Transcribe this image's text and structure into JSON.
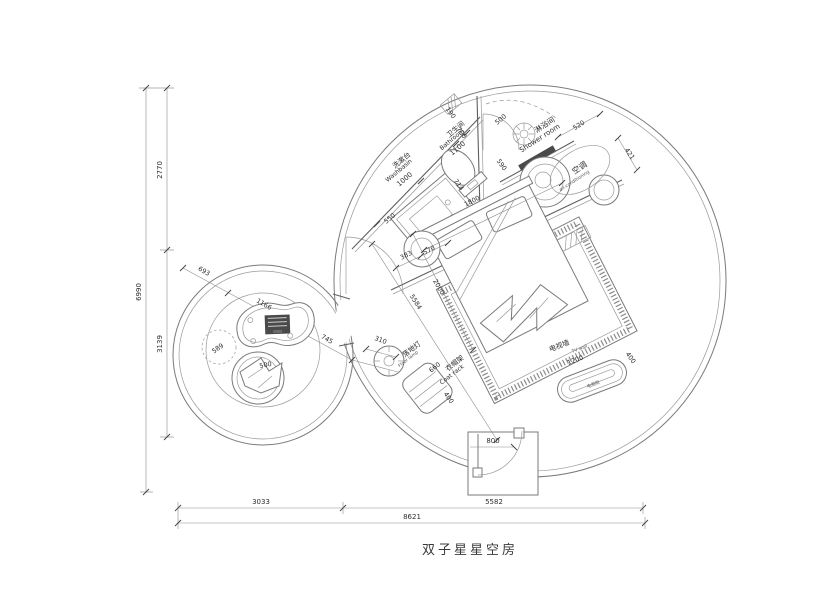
{
  "drawing": {
    "title": "双子星星空房",
    "rooms": {
      "washbasin": {
        "zh": "洗漱台",
        "en": "Washbasin",
        "dim": "1000"
      },
      "bathroom": {
        "zh": "卫生间",
        "en": "Bathroom",
        "dim": "1100"
      },
      "shower": {
        "zh": "淋浴间",
        "en": "Shower room"
      },
      "ac": {
        "zh": "空调",
        "en": "air-conditioning"
      },
      "floor_lamp": {
        "zh": "落地灯",
        "en": "Floor lamp"
      },
      "coat_rack": {
        "zh": "衣帽架",
        "en": "Coat rack"
      },
      "tv_wall": {
        "zh": "电视墙",
        "en": "TV wall"
      },
      "tv_cabinet": {
        "zh": "电视柜"
      }
    },
    "dims": {
      "left_total": "6990",
      "left_upper": "2770",
      "left_lower": "3139",
      "bottom_left": "3033",
      "bottom_right": "5582",
      "bottom_total": "8621",
      "counter_side": "550",
      "gap_190": "190",
      "door_700": "700",
      "shower_door": "500",
      "toilet_590": "590",
      "toilet_714": "714",
      "bed_width": "1800",
      "ac_520": "520",
      "ac_421": "421",
      "stool_383": "383",
      "stool_570": "570",
      "bed_length": "2000",
      "diag": "5584",
      "lamp_dia": "310",
      "rack_660": "660",
      "rack_400": "400",
      "tv_1200": "1200",
      "tv_400": "400",
      "entry_800": "800",
      "chain_693": "693",
      "chain_1166": "1166",
      "chain_745": "745",
      "pouf_589": "589",
      "chair_500": "500"
    }
  }
}
